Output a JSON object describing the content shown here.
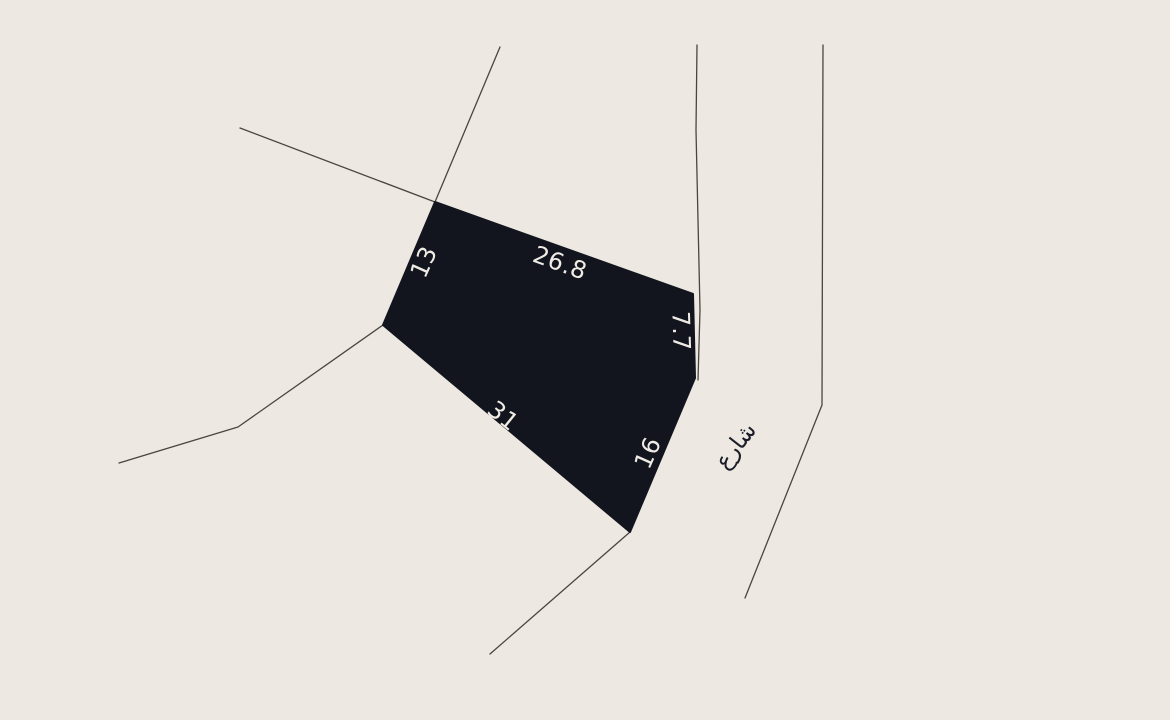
{
  "map": {
    "colors": {
      "background": "#EDE9E2",
      "parcel_fill": "#13151E",
      "parcel_stroke": "#13151E",
      "dimension_text": "#F0ECE5",
      "road_line": "#4A453E",
      "street_text": "#1B1D26"
    },
    "parcel": {
      "points": "435,202 693,294 695,378 630,532 383,325",
      "dimensions": [
        {
          "side": "northwest",
          "value": "13"
        },
        {
          "side": "north",
          "value": "26.8"
        },
        {
          "side": "east",
          "value": "7.7"
        },
        {
          "side": "southwest",
          "value": "31"
        },
        {
          "side": "southeast",
          "value": "16"
        }
      ]
    },
    "street": {
      "label": "شارع"
    },
    "roads": [
      {
        "points": "240,128 435,202"
      },
      {
        "points": "500,47 435,202"
      },
      {
        "points": "697,45 696,130 700,310 698,380"
      },
      {
        "points": "823,45 822,405 745,598"
      },
      {
        "points": "383,325 238,427 119,463"
      },
      {
        "points": "630,532 490,654"
      }
    ]
  }
}
